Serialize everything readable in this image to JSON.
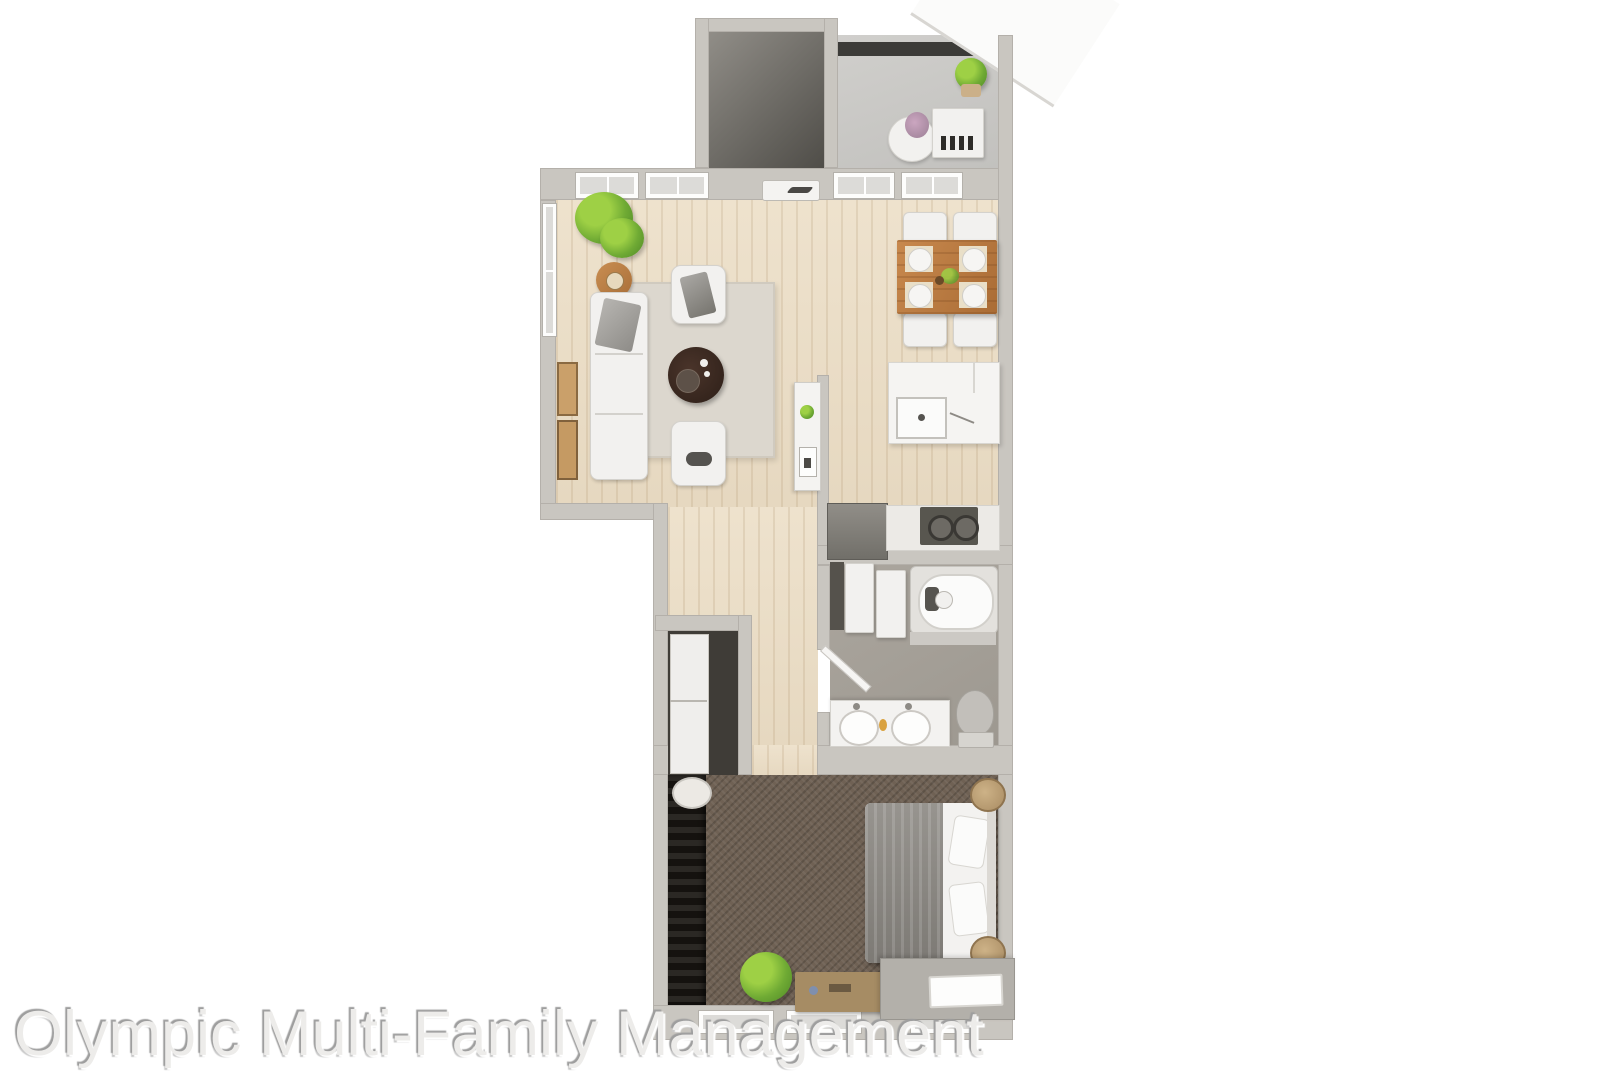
{
  "watermark": {
    "text": "Olympic Multi-Family Management"
  },
  "plan": {
    "type": "3d-rendered-floor-plan-top-view",
    "rooms": [
      "balcony",
      "storage-closet",
      "living-room",
      "dining-area",
      "kitchen",
      "hallway",
      "laundry-closet",
      "bathroom",
      "walk-in-closet",
      "bedroom"
    ],
    "furniture": [
      "sofa",
      "armchair",
      "armchair",
      "round-coffee-table",
      "area-rug",
      "side-table",
      "side-table",
      "potted-plant",
      "wall-art",
      "dining-table",
      "dining-chair x4",
      "kitchen-island-sink",
      "range-cooktop",
      "refrigerator",
      "hall-console-shelf",
      "bathtub",
      "double-vanity-sinks",
      "toilet",
      "linen-shelves",
      "stacked-washer-dryer",
      "bed",
      "pillows",
      "rolled-towel-baskets",
      "bedroom-plant",
      "storage-bench",
      "desk",
      "balcony-table",
      "balcony-bench",
      "balcony-plant"
    ]
  },
  "colors": {
    "wall": "#c9c6c0",
    "wood-floor": "#e9dcc6",
    "concrete-floor": "#c9c8c5",
    "tile-floor": "#a5a098",
    "carpet": "#6f6154",
    "rug": "#dcd7ce",
    "accent-wood": "#b97b44",
    "dark-closet": "#1d1a17",
    "coffee-table": "#3a2a20",
    "watermark-gray": "#c9c9c9"
  }
}
